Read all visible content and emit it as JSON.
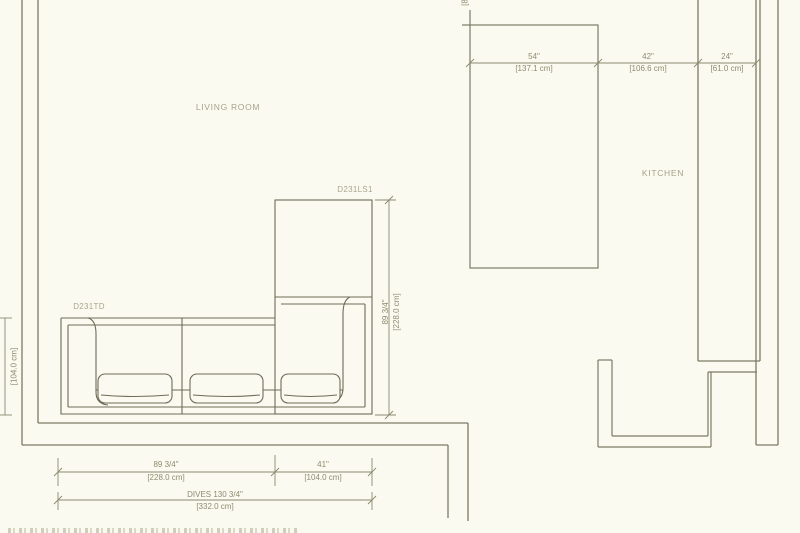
{
  "plan": {
    "rooms": {
      "living_room": "LIVING ROOM",
      "kitchen": "KITCHEN"
    },
    "furniture_labels": {
      "sofa_section": "D231TD",
      "chaise_section": "D231LS1"
    },
    "top_dimensions": [
      {
        "inches": "54\"",
        "cm": "[137.1 cm]"
      },
      {
        "inches": "42\"",
        "cm": "[106.6 cm]"
      },
      {
        "inches": "24\"",
        "cm": "[61.0 cm]"
      }
    ],
    "right_dimension": {
      "inches": "89 3/4\"",
      "cm": "[228.0 cm]"
    },
    "left_dimension": {
      "cm": "[104.0 cm]"
    },
    "bottom_dimensions": [
      {
        "inches": "89 3/4\"",
        "cm": "[228.0 cm]"
      },
      {
        "inches": "41\"",
        "cm": "[104.0 cm]"
      }
    ],
    "total_dimension": {
      "label": "DIVES 130 3/4\"",
      "cm": "[332.0 cm]"
    },
    "top_edge_partial_label": "[8",
    "colors": {
      "background": "#fbfaf1",
      "wall_line": "#7c7b63",
      "sofa_line": "#6d6c57",
      "dimension_line": "#8b8a6e",
      "dimension_text": "#8d8b6d",
      "room_label_text": "#a5a288"
    }
  }
}
